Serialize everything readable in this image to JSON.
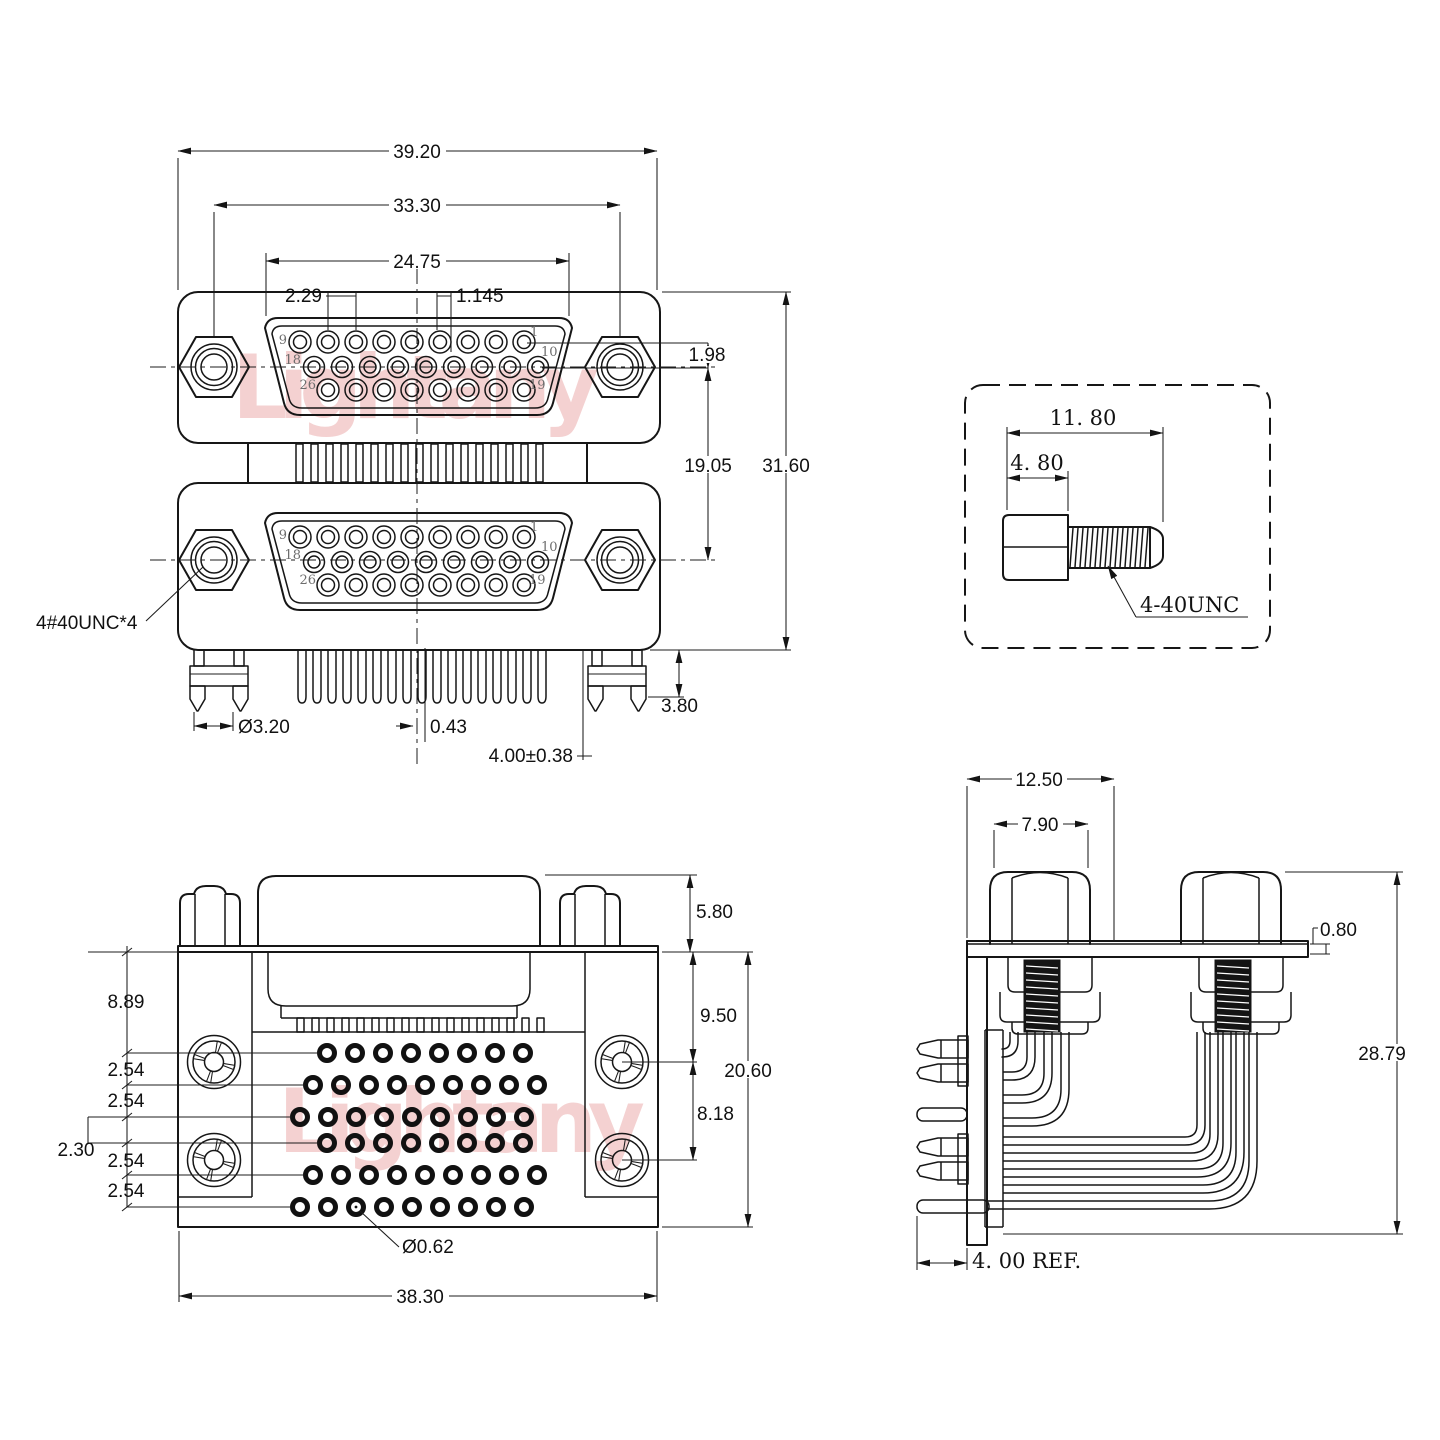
{
  "watermark": {
    "text": "Lightany"
  },
  "front_view": {
    "dims": {
      "overall_width": "39.20",
      "mount_span": "33.30",
      "face_width": "24.75",
      "pin_pitch": "2.29",
      "half_pitch": "1.145",
      "row_offset": "1.98",
      "port_spacing": "19.05",
      "overall_height": "31.60",
      "bracket_height": "3.80",
      "bracket_hole": "Ø3.20",
      "center_offset": "0.43",
      "tail_length": "4.00±0.38"
    },
    "screw_note": "4#40UNC*4",
    "pins": {
      "p1": "1",
      "p9": "9",
      "p10": "10",
      "p18": "18",
      "p19": "19",
      "p26": "26"
    }
  },
  "screw_detail": {
    "dims": {
      "overall_length": "11. 80",
      "head_length": "4. 80"
    },
    "thread_spec": "4-40UNC"
  },
  "bottom_view": {
    "dims": {
      "shell_height": "5.80",
      "edge_to_row1": "8.89",
      "row_pitches": [
        "2.54",
        "2.54",
        "2.54",
        "2.54"
      ],
      "row_gap": "2.30",
      "edge_to_screw": "9.50",
      "screw_pitch": "8.18",
      "body_height": "20.60",
      "hole_dia": "Ø0.62",
      "body_width": "38.30"
    }
  },
  "side_view": {
    "dims": {
      "standoff_span": "12.50",
      "standoff_width": "7.90",
      "plate_thickness": "0.80",
      "overall_height": "28.79",
      "pin_length_ref": "4. 00 REF."
    }
  }
}
